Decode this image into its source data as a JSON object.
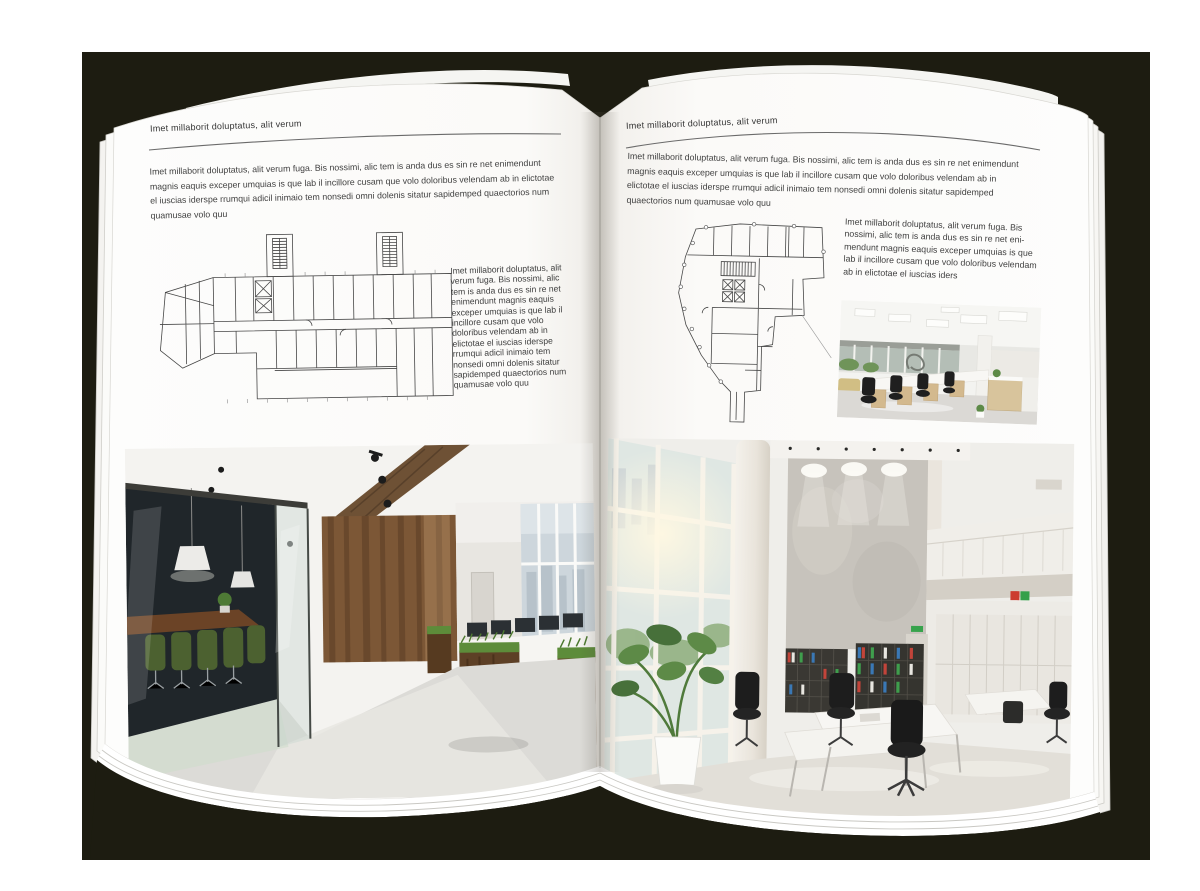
{
  "document": {
    "kind": "open-brochure-spread-mockup",
    "colors": {
      "backdrop": "#1d1c11",
      "page": "#ffffff",
      "text": "#3d3d3d",
      "rule": "#6a6a6a",
      "wood_accent": "#7c5736",
      "plant_green": "#5d8a47",
      "chair_green": "#4c6130"
    }
  },
  "left_page": {
    "header": "Imet millaborit doluptatus, alit verum",
    "intro": "Imet millaborit doluptatus, alit verum fuga. Bis nossimi, alic tem is anda dus es sin re net enimendunt magnis eaquis exceper umquias is que lab il incillore cusam que volo doloribus velendam ab in elictotae el iuscias iderspe rrumqui adicil inimaio tem nonsedi omni dolenis sitatur sapidemped quaectorios num quamusae volo quu",
    "caption": "Imet millaborit doluptatus, alit verum fuga. Bis nossimi, alic tem is anda dus es sin re net enimendunt magnis eaquis exceper umquias is que lab il incillore cusam que volo doloribus velendam ab in elictotae el iuscias iderspe rrumqui adicil inimaio tem nonsedi omni dolenis sitatur sapidemped quaectorios num quamusae volo quu",
    "floor_plan": "architectural-floor-plan-long-building",
    "photo": "office-interior-dark-wood-glass-meeting-room"
  },
  "right_page": {
    "header": "Imet millaborit doluptatus, alit verum",
    "intro": "Imet millaborit doluptatus, alit verum fuga. Bis nossimi, alic tem is anda dus es sin re net enimendunt magnis eaquis exceper umquias is que lab il incillore cusam que volo doloribus velendam ab in elictotae el iuscias iderspe rrumqui adicil inimaio tem nonsedi omni dolenis sitatur sapidemped quaectorios num quamusae volo quu",
    "caption": "Imet millaborit doluptatus, alit verum fuga. Bis nossimi, alic tem is anda dus es sin re net eni-mendunt magnis eaquis exceper umquias is que lab il incillore cusam que volo doloribus velendam ab in elictotae el iuscias iders",
    "floor_plan": "architectural-floor-plan-irregular-building",
    "photo_small": "office-interior-white-workstations",
    "photo": "office-interior-bright-atrium-bookshelves"
  }
}
